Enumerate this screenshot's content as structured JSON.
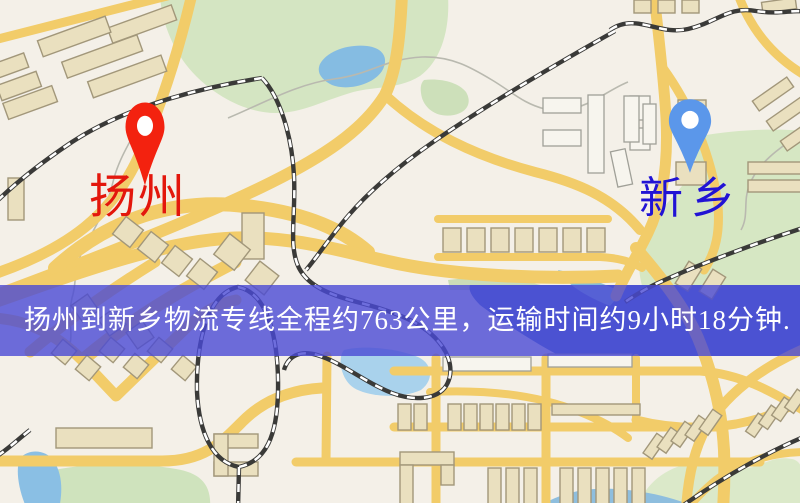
{
  "map": {
    "origin_marker": {
      "label": "扬州",
      "pin_color": "#f3220f",
      "label_color": "#e3170c"
    },
    "destination_marker": {
      "label": "新乡",
      "pin_color": "#5b97ea",
      "label_color": "#2113d4"
    },
    "info_banner": {
      "text": "扬州到新乡物流专线全程约763公里，运输时间约9小时18分钟.",
      "distance_text": "763公里",
      "duration_text": "9小时18分钟",
      "background_color": "#4a4ad4",
      "text_color": "#ffffff"
    },
    "palette": {
      "map_background": "#f4f0e8",
      "road_yellow": "#f2cc69",
      "park_green": "#d4e5c2",
      "water_blue": "#85bce2",
      "railway_dark": "#3a3a38"
    }
  }
}
